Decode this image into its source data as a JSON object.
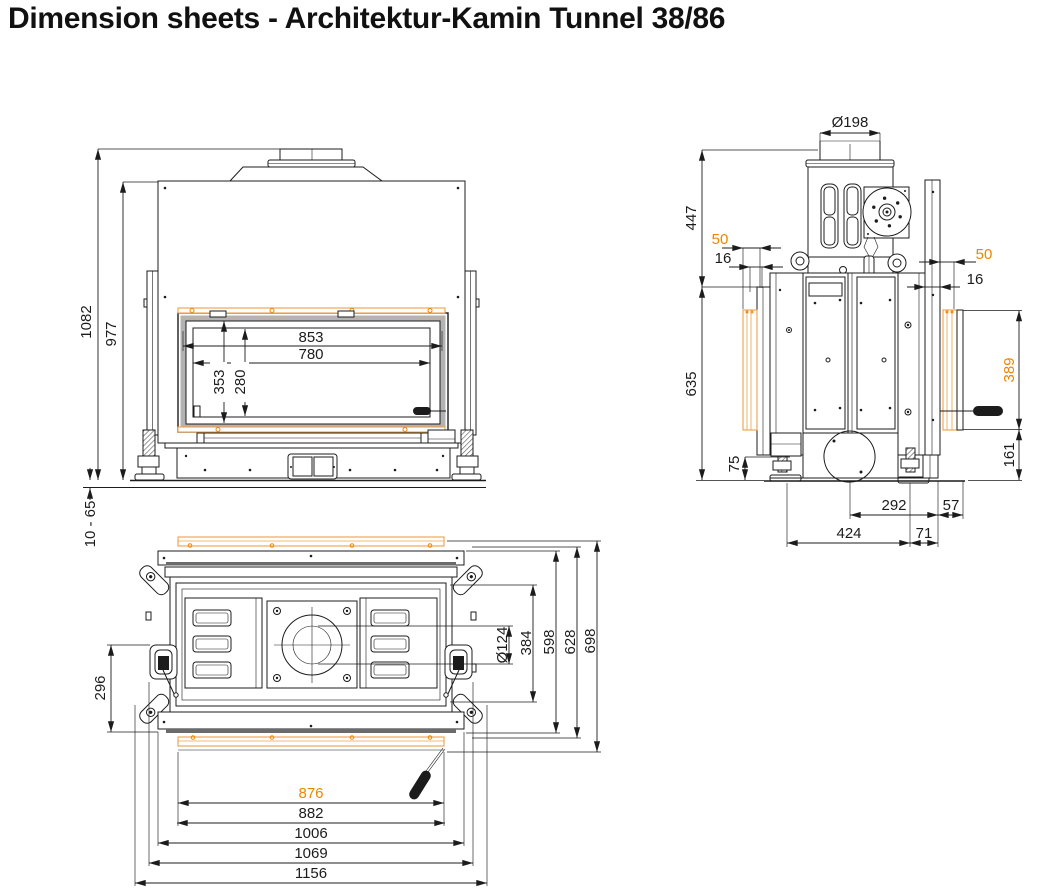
{
  "title": "Dimension sheets - Architektur-Kamin Tunnel 38/86",
  "colors": {
    "line": "#1c1c1c",
    "accent": "#ee8600",
    "frame_trim": "#efa04a",
    "window_gray": "#b3b3b3",
    "background": "#ffffff"
  },
  "views": {
    "front_view": {
      "dims": {
        "total_height": "1082",
        "body_height": "977",
        "foot_adjust_range": "10 - 65",
        "opening_width": "853",
        "glass_width": "780",
        "opening_height": "353",
        "glass_height": "280"
      }
    },
    "side_view": {
      "dims": {
        "flue_diameter": "Ø198",
        "upper_section_height": "447",
        "left_offset_outer": "50",
        "left_offset_inner": "16",
        "right_offset_outer": "50",
        "right_offset_inner": "16",
        "body_height": "635",
        "frame_profile_height": "389",
        "frame_bottom_height": "161",
        "foot_height": "75",
        "depth_center_back": "292",
        "depth_back_offset": "57",
        "depth_feet": "424",
        "depth_back_edge": "71"
      }
    },
    "top_view": {
      "dims": {
        "latch_depth": "296",
        "flue_hole_diameter": "Ø124",
        "inner_depth": "384",
        "body_depth": "598",
        "outer_depth": "628",
        "total_depth": "698",
        "glass_frame_inner_width": "876",
        "glass_frame_width": "882",
        "body_width": "1006",
        "latch_width": "1069",
        "total_width": "1156"
      }
    }
  }
}
